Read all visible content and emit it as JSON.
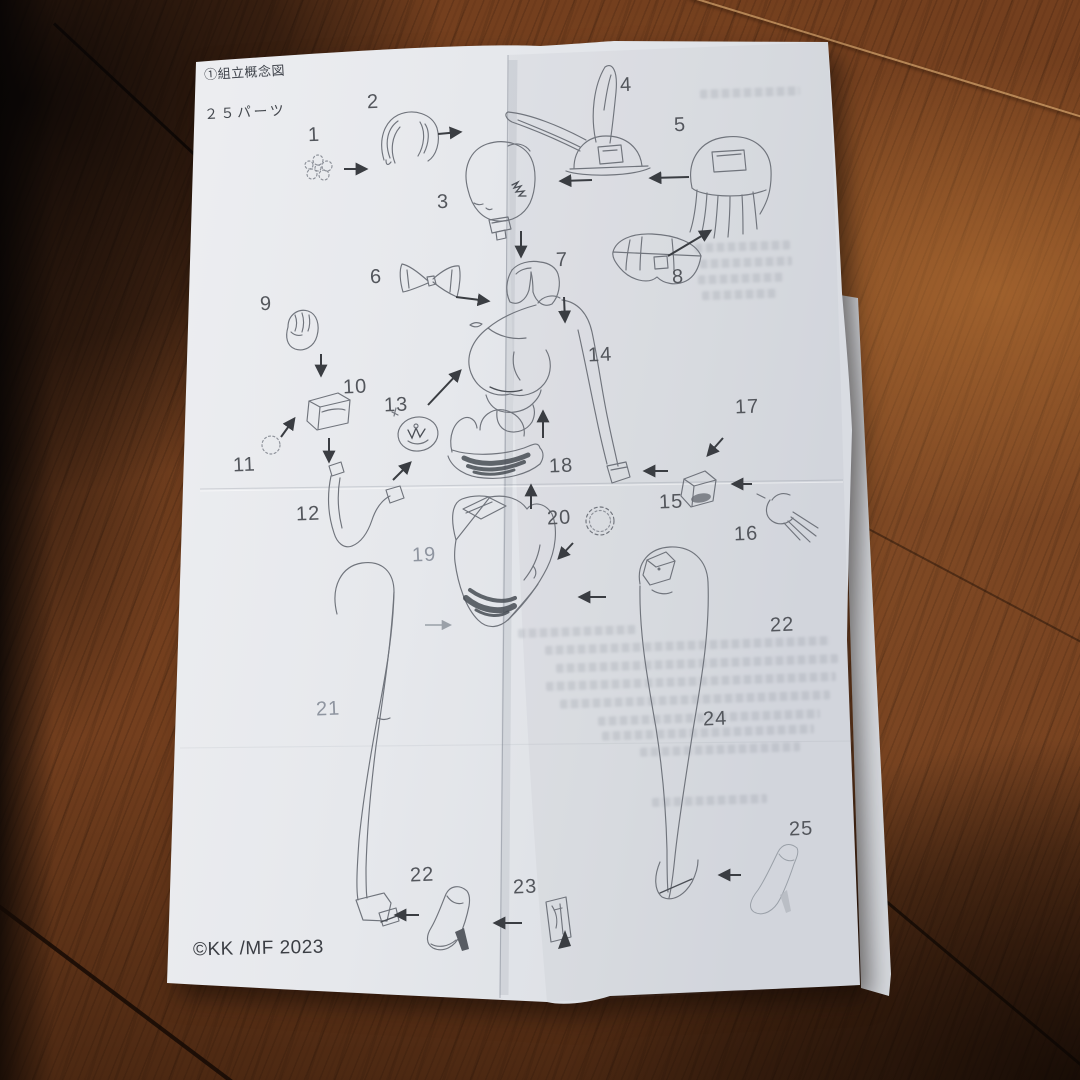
{
  "photo": {
    "colors": {
      "paper": "#e7e9ec",
      "wood_dark": "#3a1d0c",
      "wood_mid": "#743f1e",
      "wood_light": "#9a6a38",
      "sketch_line": "#70747c",
      "arrow": "#3a3d42"
    },
    "sheet": {
      "title": "①組立概念図",
      "parts_count_label": "２５パーツ",
      "copyright": "©KK /MF 2023",
      "part_labels": [
        {
          "num": "1",
          "x": 320,
          "y": 136
        },
        {
          "num": "2",
          "x": 379,
          "y": 103
        },
        {
          "num": "3",
          "x": 449,
          "y": 203
        },
        {
          "num": "4",
          "x": 632,
          "y": 86
        },
        {
          "num": "5",
          "x": 686,
          "y": 126
        },
        {
          "num": "6",
          "x": 382,
          "y": 278
        },
        {
          "num": "7",
          "x": 568,
          "y": 261
        },
        {
          "num": "8",
          "x": 684,
          "y": 278
        },
        {
          "num": "9",
          "x": 272,
          "y": 305
        },
        {
          "num": "10",
          "x": 355,
          "y": 388
        },
        {
          "num": "11",
          "x": 245,
          "y": 466
        },
        {
          "num": "12",
          "x": 308,
          "y": 515
        },
        {
          "num": "13",
          "x": 396,
          "y": 406
        },
        {
          "num": "14",
          "x": 600,
          "y": 356
        },
        {
          "num": "15",
          "x": 671,
          "y": 503
        },
        {
          "num": "16",
          "x": 746,
          "y": 535
        },
        {
          "num": "17",
          "x": 747,
          "y": 408
        },
        {
          "num": "18",
          "x": 561,
          "y": 467
        },
        {
          "num": "19",
          "x": 424,
          "y": 556,
          "faded": true
        },
        {
          "num": "20",
          "x": 559,
          "y": 519
        },
        {
          "num": "21",
          "x": 328,
          "y": 710,
          "faded": true
        },
        {
          "num": "22",
          "x": 782,
          "y": 626
        },
        {
          "num": "24",
          "x": 715,
          "y": 720
        },
        {
          "num": "25",
          "x": 801,
          "y": 830
        },
        {
          "num": "22",
          "x": 422,
          "y": 876
        },
        {
          "num": "23",
          "x": 525,
          "y": 888
        }
      ]
    }
  }
}
